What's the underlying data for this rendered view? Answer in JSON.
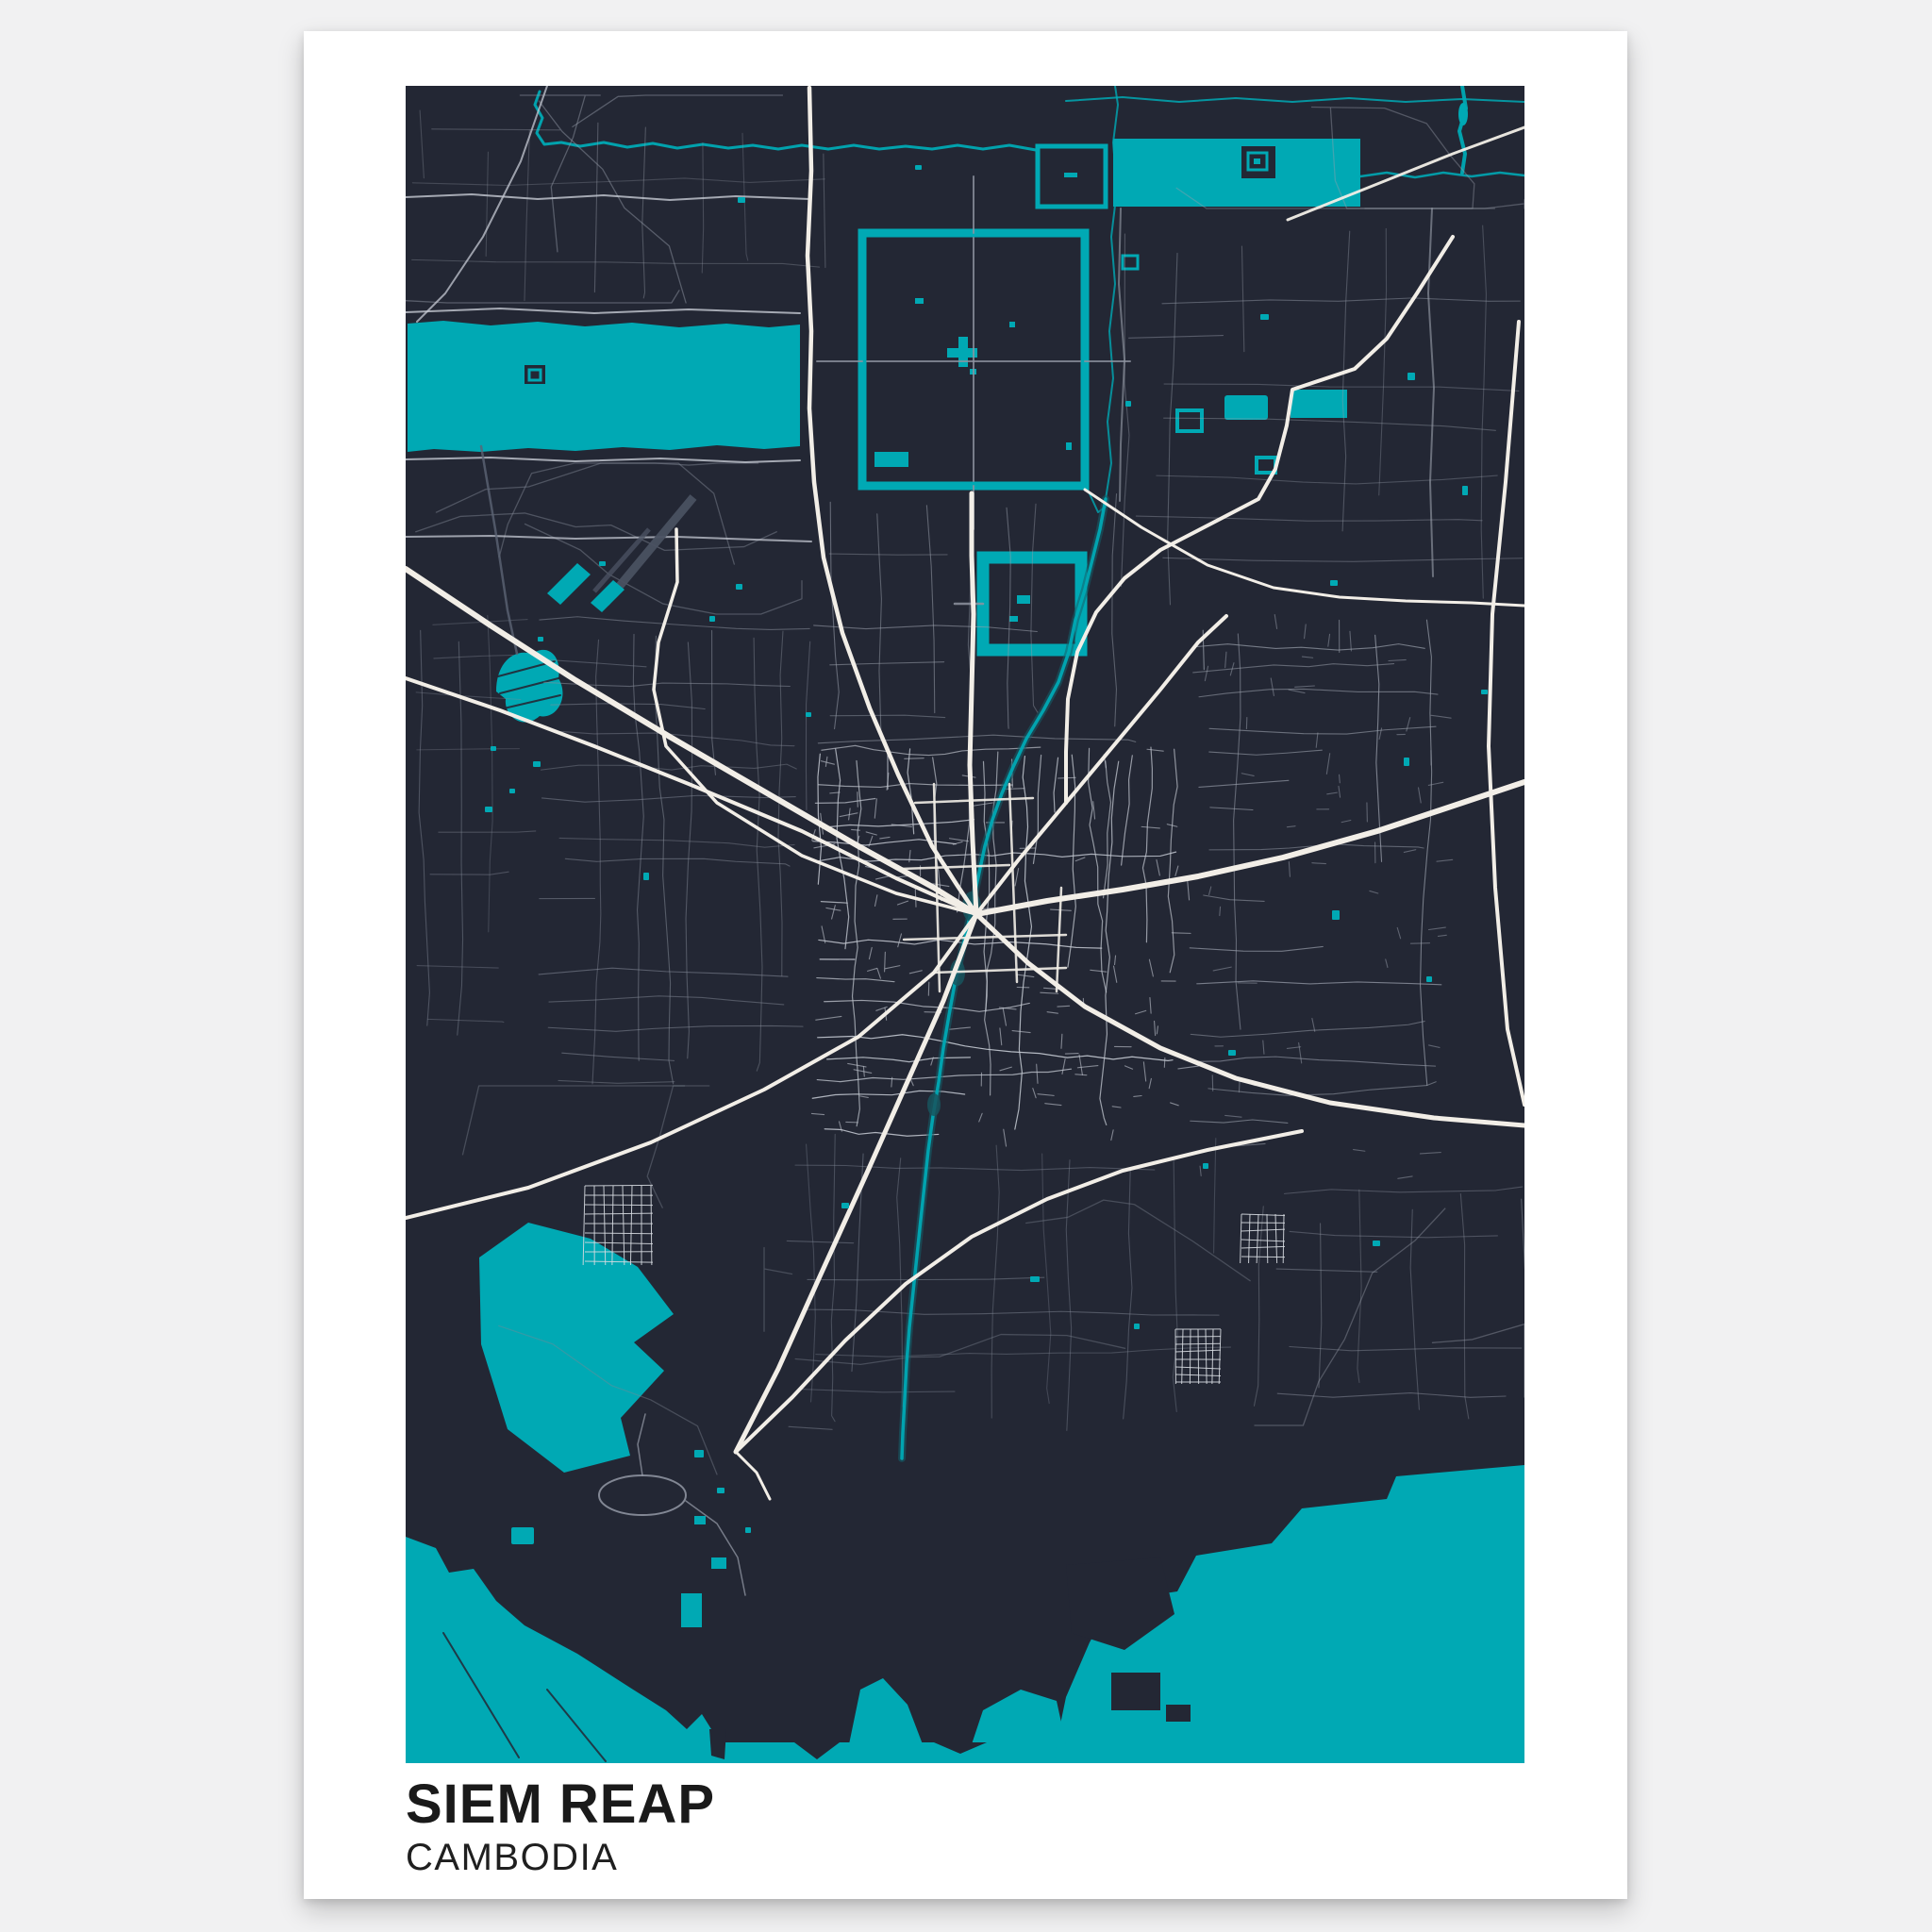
{
  "poster": {
    "title": "SIEM REAP",
    "subtitle": "CAMBODIA"
  },
  "colors": {
    "page_background": "#f1f1f2",
    "paper": "#ffffff",
    "map_background": "#232734",
    "water": "#00a9b4",
    "river_halo": "#14606b",
    "park": "#17555e",
    "road_major": "#f2eee7",
    "road_medium": "#c6cad3",
    "road_minor": "#9aa0ac",
    "road_minor_bright": "#c2c7d0",
    "pocket_grid": "#d6dae0",
    "runway": "#4a5161",
    "title_text": "#1a1a1a",
    "subtitle_text": "#1f1f1f"
  }
}
